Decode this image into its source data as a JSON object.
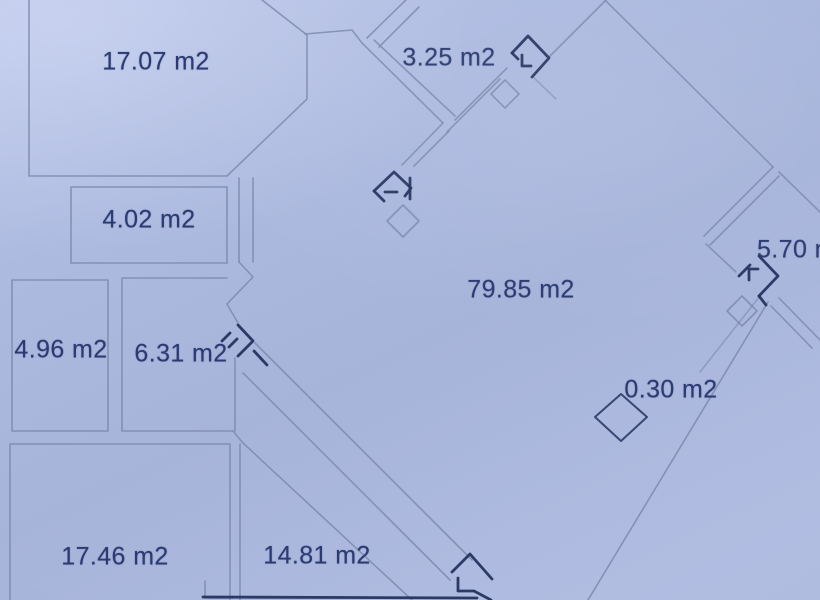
{
  "floor_plan": {
    "rooms": [
      {
        "id": "room-1",
        "area": "17.07 m2"
      },
      {
        "id": "room-2",
        "area": "3.25 m2"
      },
      {
        "id": "room-3",
        "area": "4.02 m2"
      },
      {
        "id": "room-4",
        "area": "79.85 m2"
      },
      {
        "id": "room-5",
        "area": "5.70 m2"
      },
      {
        "id": "room-6",
        "area": "4.96 m2"
      },
      {
        "id": "room-7",
        "area": "6.31 m2"
      },
      {
        "id": "room-8",
        "area": "0.30 m2"
      },
      {
        "id": "room-9",
        "area": "17.46 m2"
      },
      {
        "id": "room-10",
        "area": "14.81 m2"
      }
    ]
  },
  "colors": {
    "background": "#abb8de",
    "wall-line": "#7d89ad",
    "ink": "#26335f",
    "label-text": "#2b3a72"
  }
}
